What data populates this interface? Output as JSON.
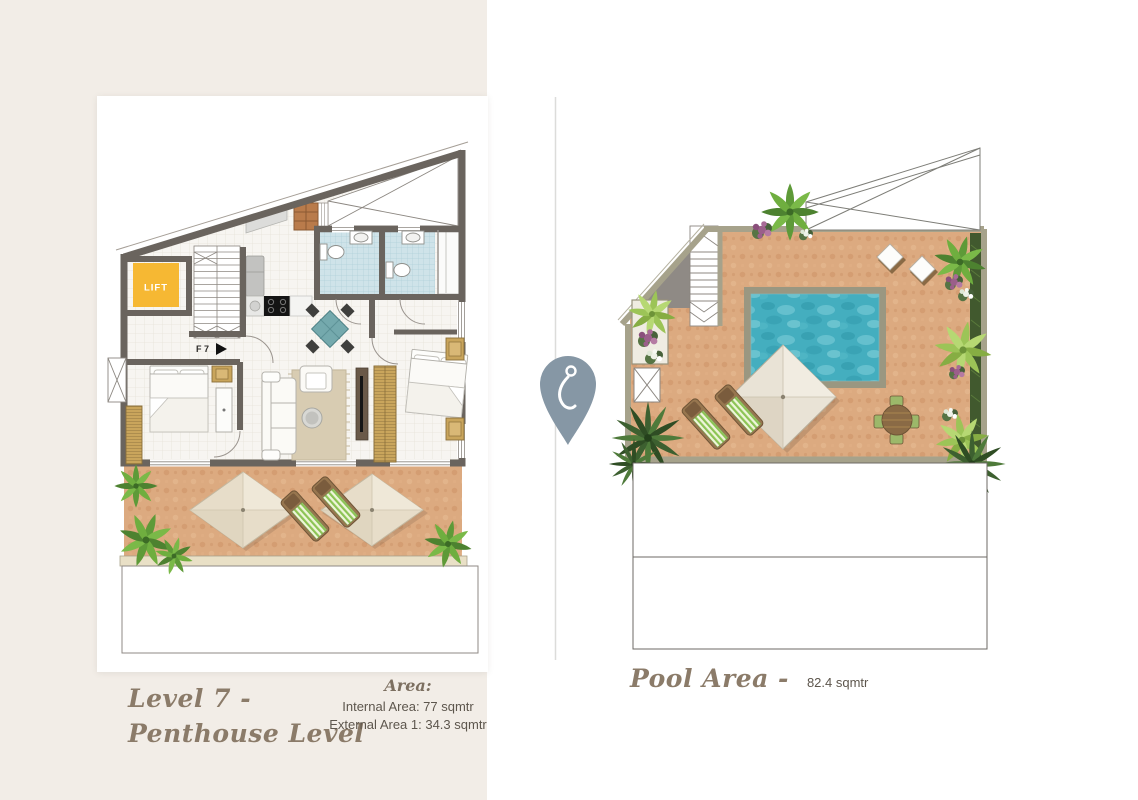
{
  "page": {
    "background": "#ffffff",
    "panel_background": "#f2ede7"
  },
  "divider": {
    "pin_icon": "map-pin"
  },
  "left_plan": {
    "lift_label": "LIFT",
    "door_label": "F 7",
    "title_line1": "Level 7 -",
    "title_line2": "Penthouse Level",
    "area_heading": "Area:",
    "area_internal": "Internal Area: 77 sqmtr",
    "area_external": "External Area 1: 34.3 sqmtr"
  },
  "pool_plan": {
    "title": "Pool Area -",
    "area_value": "82.4 sqmtr"
  },
  "colors": {
    "panel": "#f2ede7",
    "walls_dark": "#6a645e",
    "walls_light": "#a6a28b",
    "terrace_tile": "#dcaa80",
    "pool_water": "#45b1c2",
    "lift_yellow": "#f6b833",
    "bath_tile": "#cfe3e9",
    "wood_gold": "#c9a55c",
    "pin_blue_gray": "#8697a5",
    "title_text": "#8b7b69",
    "body_text": "#5d564d"
  }
}
